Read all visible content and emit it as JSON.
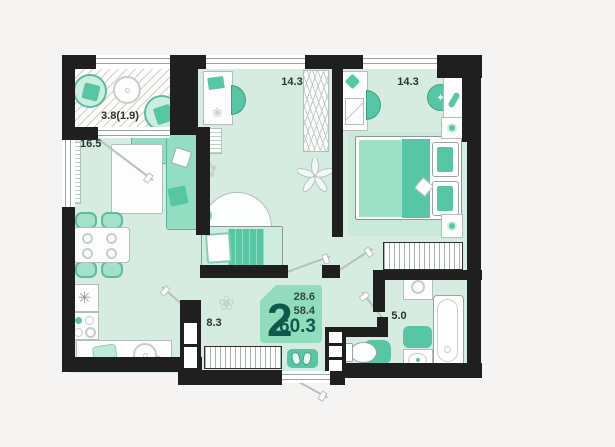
{
  "plan": {
    "unit_badge": {
      "rooms": "2",
      "area_total": "60.3",
      "area_top": "28.6",
      "area_mid": "58.4"
    },
    "rooms": {
      "balcony": {
        "name": "balcony",
        "area": "3.8(1.9)"
      },
      "living_kitchen": {
        "name": "living-kitchen",
        "area": "16.5"
      },
      "room_middle": {
        "name": "room",
        "area": "14.3"
      },
      "bedroom": {
        "name": "bedroom",
        "area": "14.3"
      },
      "hallway": {
        "name": "hallway",
        "area": "8.3"
      },
      "bathroom": {
        "name": "bathroom",
        "area": "5.0"
      }
    }
  },
  "colors": {
    "wall": "#1f1f1f",
    "floor": "#d6ece1",
    "accent": "#57c6a5",
    "accent-dark": "#3da183",
    "accent-light": "#a5e1c9",
    "badge-bg": "#92dcbe",
    "badge-text": "#0e594b",
    "outline": "#b3beba",
    "label": "#2d3431",
    "bg": "#f5f4f2"
  }
}
